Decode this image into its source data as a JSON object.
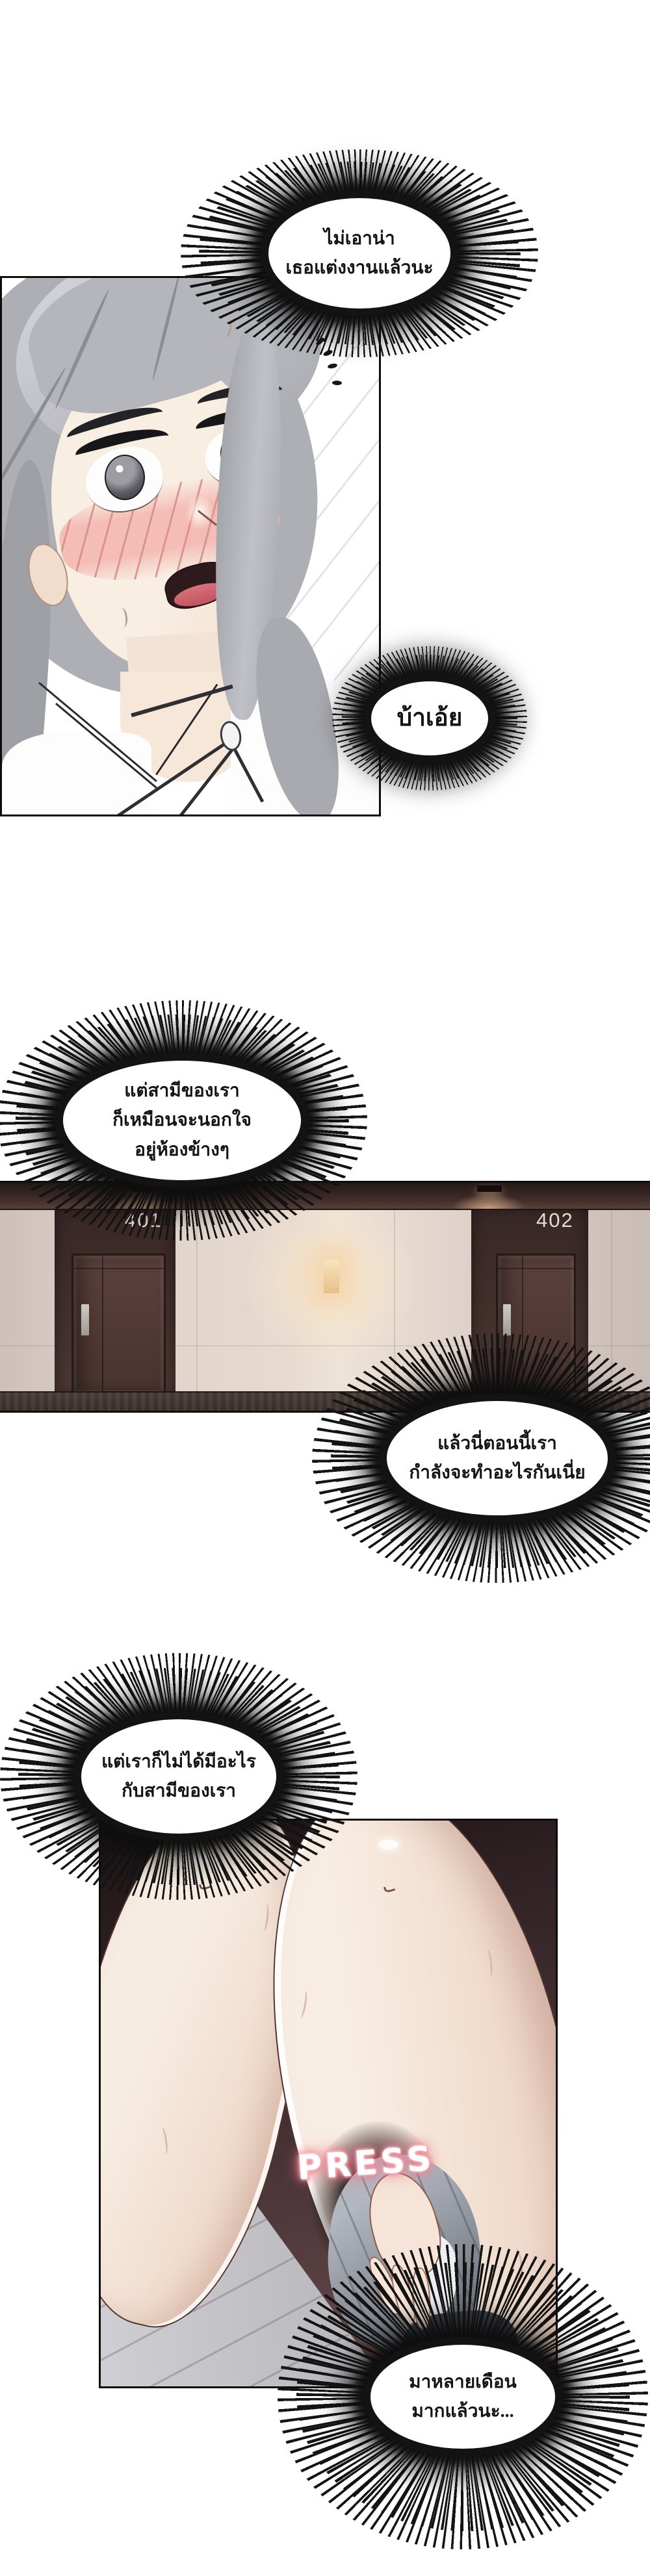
{
  "page": {
    "kind": "webtoon-comic-strip",
    "colors": {
      "page_bg": "#ffffff",
      "ink": "#141414",
      "hall_wall": "#e7dbd0",
      "hall_wood": "#44312e",
      "door_number_color": "#e8dbd3",
      "legs_bg": "#453134",
      "skin": "#f6eadd",
      "hair": "#b6b7bd",
      "blush": "#efb3ae",
      "sfx_color": "#ffffff",
      "sfx_glow": "#f2808f"
    }
  },
  "thought_bubbles": [
    {
      "id": "bubble-1",
      "lines": [
        "ไม่เอาน่า",
        "เธอแต่งงานแล้วนะ"
      ]
    },
    {
      "id": "bubble-2",
      "lines": [
        "บ้าเอ้ย"
      ]
    },
    {
      "id": "bubble-3",
      "lines": [
        "แต่สามีของเรา",
        "ก็เหมือนจะนอกใจ",
        "อยู่ห้องข้างๆ"
      ]
    },
    {
      "id": "bubble-4",
      "lines": [
        "แล้วนี่ตอนนี้เรา",
        "กำลังจะทำอะไรกันเนี่ย"
      ]
    },
    {
      "id": "bubble-5",
      "lines": [
        "แต่เราก็ไม่ได้มีอะไร",
        "กับสามีของเรา"
      ]
    },
    {
      "id": "bubble-6",
      "lines": [
        "มาหลายเดือน",
        "มากแล้วนะ..."
      ]
    }
  ],
  "hallway_panel": {
    "left_door_number": "401",
    "right_door_number": "402"
  },
  "legs_panel": {
    "sfx_text": "PRESS"
  }
}
